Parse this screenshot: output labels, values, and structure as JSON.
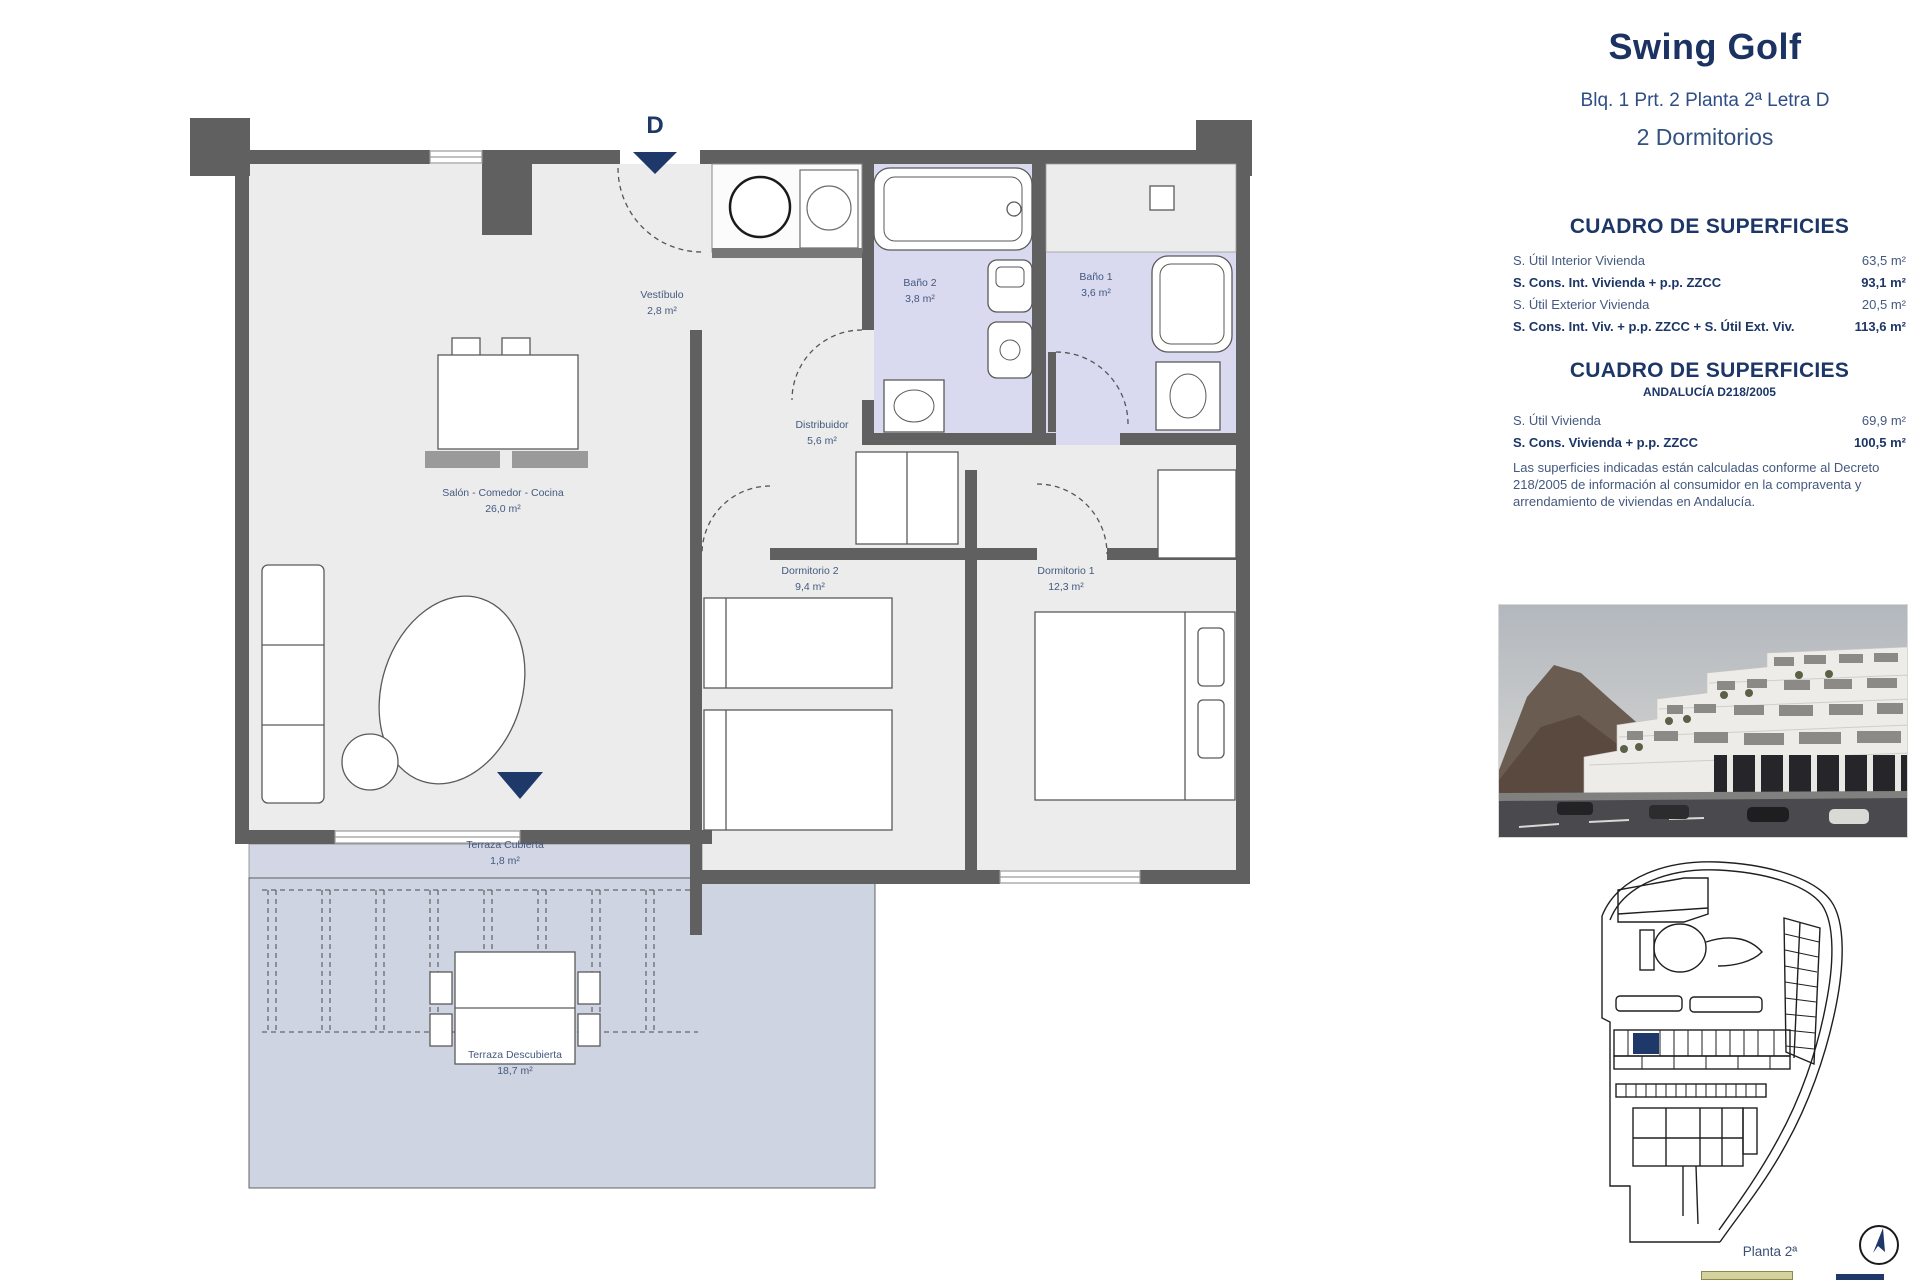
{
  "header": {
    "title": "Swing Golf",
    "subtitle": "Blq. 1 Prt. 2 Planta 2ª Letra D",
    "bedrooms": "2 Dormitorios"
  },
  "surfaces_table_1": {
    "title": "CUADRO DE SUPERFICIES",
    "rows": [
      {
        "label": "S. Útil Interior Vivienda",
        "value": "63,5 m²"
      },
      {
        "label": "S. Cons. Int. Vivienda + p.p. ZZCC",
        "value": "93,1 m²"
      },
      {
        "label": "S. Útil Exterior Vivienda",
        "value": "20,5 m²"
      },
      {
        "label": "S. Cons. Int. Viv. + p.p. ZZCC + S. Útil Ext. Viv.",
        "value": "113,6 m²"
      }
    ]
  },
  "surfaces_table_2": {
    "title": "CUADRO DE SUPERFICIES",
    "subtitle": "ANDALUCÍA D218/2005",
    "rows": [
      {
        "label": "S. Útil Vivienda",
        "value": "69,9 m²"
      },
      {
        "label": "S. Cons. Vivienda + p.p. ZZCC",
        "value": "100,5 m²"
      }
    ],
    "disclaimer": "Las superficies indicadas están calculadas conforme al Decreto 218/2005 de información al consumidor en la compraventa y arrendamiento de viviendas en Andalucía."
  },
  "floor_plan": {
    "entrance_marker": "D",
    "rooms": {
      "vestibulo": {
        "name": "Vestíbulo",
        "area": "2,8 m²"
      },
      "bano2": {
        "name": "Baño 2",
        "area": "3,8 m²"
      },
      "bano1": {
        "name": "Baño 1",
        "area": "3,6 m²"
      },
      "distribuidor": {
        "name": "Distribuidor",
        "area": "5,6 m²"
      },
      "salon": {
        "name": "Salón - Comedor - Cocina",
        "area": "26,0 m²"
      },
      "dormitorio2": {
        "name": "Dormitorio 2",
        "area": "9,4 m²"
      },
      "dormitorio1": {
        "name": "Dormitorio 1",
        "area": "12,3 m²"
      },
      "terraza_cubierta": {
        "name": "Terraza Cubierta",
        "area": "1,8 m²"
      },
      "terraza_descubierta": {
        "name": "Terraza Descubierta",
        "area": "18,7 m²"
      }
    }
  },
  "footer": {
    "floor_label": "Planta 2ª"
  },
  "colors": {
    "accent_navy": "#1d3869",
    "wall_gray": "#606060",
    "room_fill": "#ececec",
    "bathroom_fill": "#d9d9f0",
    "terrace_fill": "#cfd4e2"
  }
}
